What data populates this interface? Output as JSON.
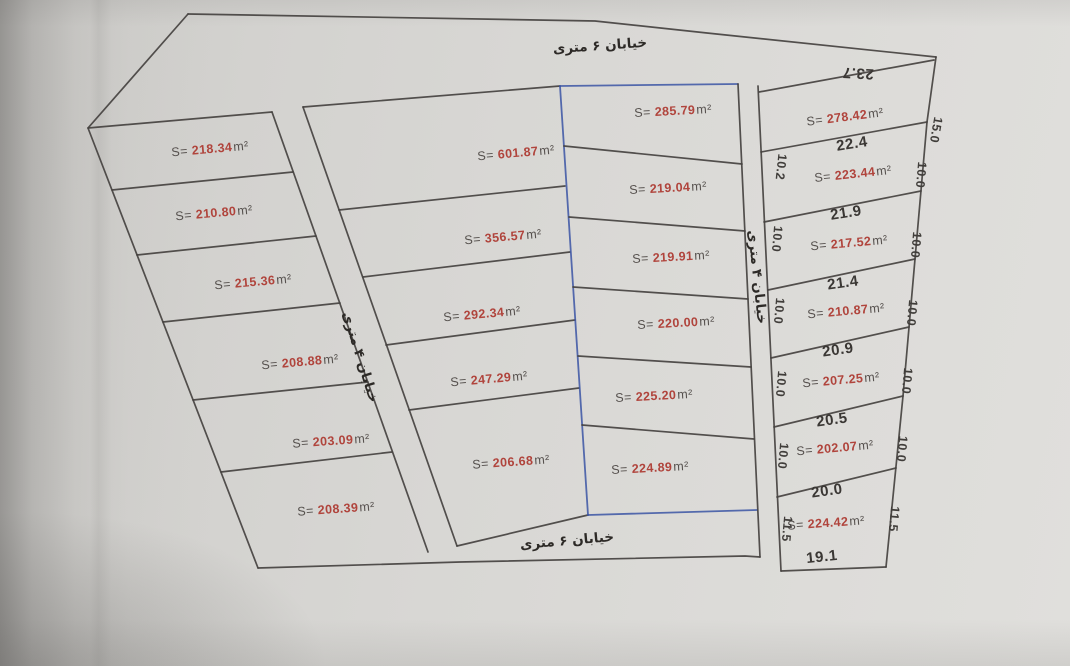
{
  "document": {
    "type": "land-subdivision-plan",
    "labels": {
      "area_prefix": "S=",
      "area_unit": "m²"
    },
    "colors": {
      "area_value_red": "#b0443c",
      "ink": "#454240",
      "blue_ink": "#3b55a5",
      "paper": "#d8d7d4"
    }
  },
  "streets": {
    "top": "خیابان ۶ متری",
    "bottom": "خیابان ۶ متری",
    "west_road": "خیابان ۴ متری",
    "east_road": "خیابان ۴ متری"
  },
  "plots": {
    "left_column": [
      {
        "area": "218.34"
      },
      {
        "area": "210.80"
      },
      {
        "area": "215.36"
      },
      {
        "area": "208.88"
      },
      {
        "area": "203.09"
      },
      {
        "area": "208.39"
      }
    ],
    "middle_column": [
      {
        "area": "601.87"
      },
      {
        "area": "356.57"
      },
      {
        "area": "292.34"
      },
      {
        "area": "247.29"
      },
      {
        "area": "206.68"
      }
    ],
    "center_right_column": [
      {
        "area": "285.79"
      },
      {
        "area": "219.04"
      },
      {
        "area": "219.91"
      },
      {
        "area": "220.00"
      },
      {
        "area": "225.20"
      },
      {
        "area": "224.89"
      }
    ],
    "right_column": [
      {
        "area": "278.42",
        "top": "23.7",
        "right": "15.0"
      },
      {
        "area": "223.44",
        "top": "22.4",
        "left": "10.2",
        "right": "10.0"
      },
      {
        "area": "217.52",
        "top": "21.9",
        "left": "10.0",
        "right": "10.0"
      },
      {
        "area": "210.87",
        "top": "21.4",
        "left": "10.0",
        "right": "10.0"
      },
      {
        "area": "207.25",
        "top": "20.9",
        "left": "10.0",
        "right": "10.0"
      },
      {
        "area": "202.07",
        "top": "20.5",
        "left": "10.0",
        "right": "10.0"
      },
      {
        "area": "224.42",
        "top": "20.0",
        "left": "11.5",
        "right": "11.5",
        "bottom": "19.1"
      }
    ]
  }
}
